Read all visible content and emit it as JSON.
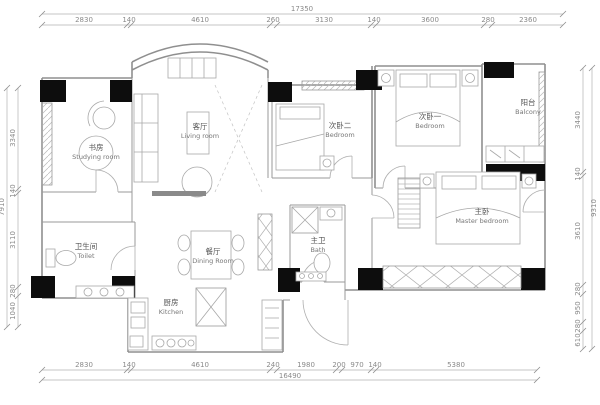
{
  "drawing": {
    "type": "residential floor plan",
    "units": "mm"
  },
  "dims": {
    "top": {
      "total": "17350",
      "segments": [
        "2830",
        "140",
        "4610",
        "260",
        "3130",
        "140",
        "3600",
        "280",
        "2360"
      ]
    },
    "bottom": {
      "total": "16490",
      "segments": [
        "2830",
        "140",
        "4610",
        "240",
        "1980",
        "200",
        "970",
        "140",
        "5380"
      ]
    },
    "left": {
      "total": "7910",
      "segments": [
        "3340",
        "140",
        "3110",
        "280",
        "1040"
      ]
    },
    "right": {
      "total": "9310",
      "segments": [
        "3440",
        "140",
        "3610",
        "280",
        "950",
        "280",
        "610"
      ]
    }
  },
  "rooms": [
    {
      "zh": "书房",
      "en": "Studying room"
    },
    {
      "zh": "客厅",
      "en": "Living room"
    },
    {
      "zh": "次卧二",
      "en": "Bedroom"
    },
    {
      "zh": "次卧一",
      "en": "Bedroom"
    },
    {
      "zh": "阳台",
      "en": "Balcony"
    },
    {
      "zh": "卫生间",
      "en": "Toilet"
    },
    {
      "zh": "餐厅",
      "en": "Dining Room"
    },
    {
      "zh": "主卫",
      "en": "Bath"
    },
    {
      "zh": "主卧",
      "en": "Master bedroom"
    },
    {
      "zh": "厨房",
      "en": "Kitchen"
    }
  ],
  "colors": {
    "background": "#ffffff",
    "walls": "#8f8f8f",
    "columns": "#0d0d0d",
    "dimension_text": "#8a8a8a",
    "label_text": "#555555"
  }
}
